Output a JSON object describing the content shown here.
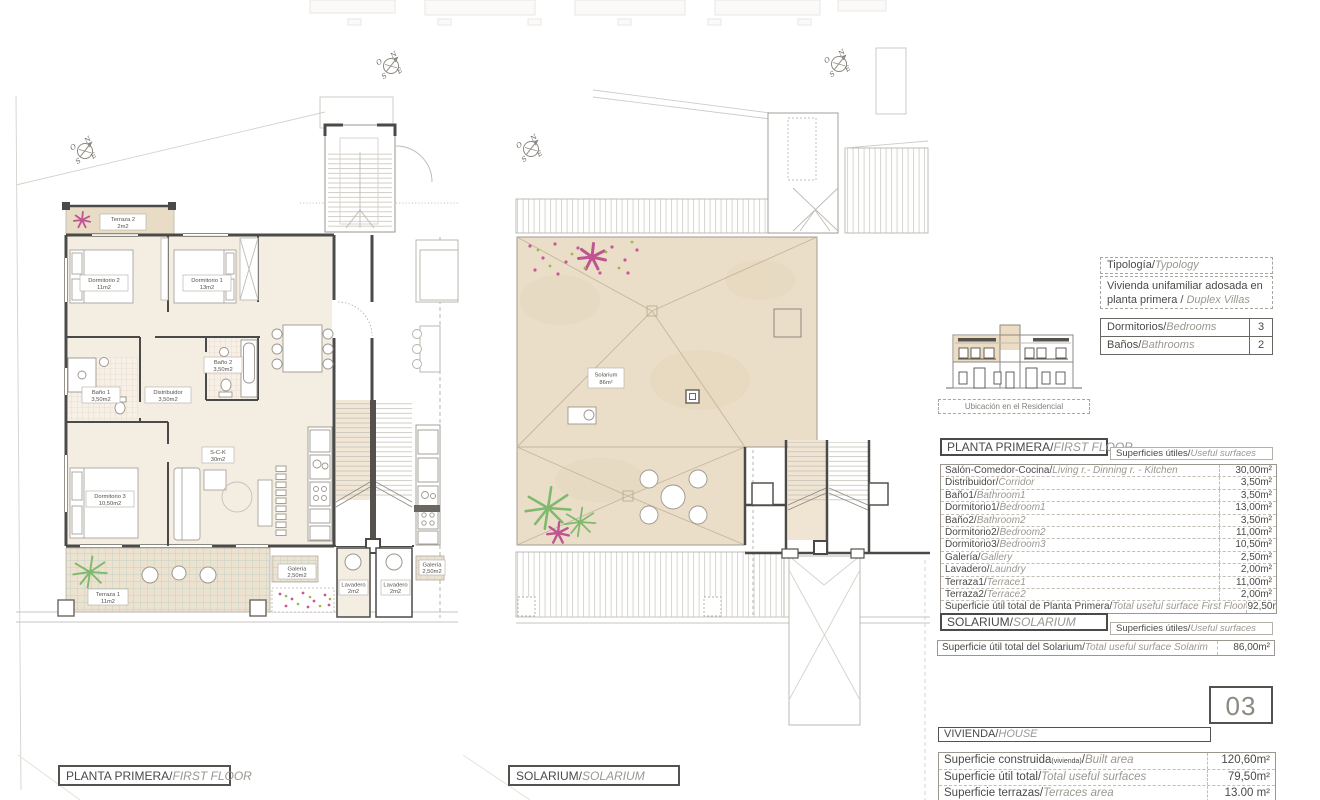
{
  "plans": {
    "compass": {
      "n": "N",
      "o": "O",
      "e": "E",
      "s": "S"
    },
    "first_floor": {
      "caption_es": "PLANTA PRIMERA/",
      "caption_en": "FIRST FLOOR",
      "rooms": [
        {
          "name": "Terraza 2",
          "area": "2m2"
        },
        {
          "name": "Dormitorio 2",
          "area": "11m2"
        },
        {
          "name": "Dormitorio 1",
          "area": "13m2"
        },
        {
          "name": "Baño 1",
          "area": "3,50m2"
        },
        {
          "name": "Baño 2",
          "area": "3,50m2"
        },
        {
          "name": "Distribuidor",
          "area": "3,50m2"
        },
        {
          "name": "Dormitorio 3",
          "area": "10,50m2"
        },
        {
          "name": "S-C-K",
          "area": "30m2"
        },
        {
          "name": "Terraza 1",
          "area": "11m2"
        },
        {
          "name": "Galería",
          "area": "2,50m2"
        },
        {
          "name": "Lavadero",
          "area": "2m2"
        },
        {
          "name": "Lavadero",
          "area": "2m2"
        },
        {
          "name": "Galería",
          "area": "2,50m2"
        }
      ]
    },
    "solarium": {
      "caption_es": "SOLARIUM/",
      "caption_en": "SOLARIUM",
      "label": {
        "name": "Solarium",
        "area": "86m²"
      }
    }
  },
  "panel": {
    "typology": {
      "title_es": "Tipología/",
      "title_en": "Typology",
      "body_es": "Vivienda unifamiliar adosada en planta primera / ",
      "body_en": "Duplex Villas"
    },
    "counts": [
      {
        "es": "Dormitorios/",
        "en": "Bedrooms",
        "value": "3"
      },
      {
        "es": "Baños/",
        "en": "Bathrooms",
        "value": "2"
      }
    ],
    "location_caption": "Ubicación en el Residencial",
    "first_floor_table": {
      "title_es": "PLANTA PRIMERA/",
      "title_en": "FIRST FLOOR",
      "subtitle_es": "Superficies útiles/",
      "subtitle_en": "Useful surfaces",
      "rows": [
        {
          "es": "Salón-Comedor-Cocina/",
          "en": "Living r.- Dinning r. - Kitchen",
          "value": "30,00m²"
        },
        {
          "es": "Distribuidor/",
          "en": "Corridor",
          "value": "3,50m²"
        },
        {
          "es": "Baño1/",
          "en": "Bathroom1",
          "value": "3,50m²"
        },
        {
          "es": "Dormitorio1/",
          "en": "Bedroom1",
          "value": "13,00m²"
        },
        {
          "es": "Baño2/",
          "en": "Bathroom2",
          "value": "3,50m²"
        },
        {
          "es": "Dormitorio2/",
          "en": "Bedroom2",
          "value": "11,00m²"
        },
        {
          "es": "Dormitorio3/",
          "en": "Bedroom3",
          "value": "10,50m²"
        },
        {
          "es": "Galería/",
          "en": "Gallery",
          "value": "2,50m²"
        },
        {
          "es": "Lavadero/",
          "en": "Laundry",
          "value": "2,00m²"
        },
        {
          "es": "Terraza1/",
          "en": "Terrace1",
          "value": "11,00m²"
        },
        {
          "es": "Terraza2/",
          "en": "Terrace2",
          "value": "2,00m²"
        },
        {
          "es": "Superficie útil total de Planta Primera/",
          "en": "Total useful surface First Floor",
          "value": "92,50m²"
        }
      ]
    },
    "solarium_table": {
      "title_es": "SOLARIUM/",
      "title_en": "SOLARIUM",
      "subtitle_es": "Superficies útiles/",
      "subtitle_en": "Useful surfaces",
      "rows": [
        {
          "es": "Superficie útil total del Solarium/",
          "en": "Total useful surface Solarim",
          "value": "86,00m²"
        }
      ]
    },
    "unit_number": "03",
    "house_table": {
      "title_es": "VIVIENDA/",
      "title_en": "HOUSE",
      "rows": [
        {
          "es": "Superficie construida",
          "sub": "(vivienda)",
          "sep": "/",
          "en": "Built area",
          "value": "120,60m²"
        },
        {
          "es": "Superficie útil total",
          "sub": "",
          "sep": "/",
          "en": "Total useful surfaces",
          "value": "79,50m²"
        },
        {
          "es": "Superficie terrazas",
          "sub": "",
          "sep": "/",
          "en": "Terraces area",
          "value": "13.00 m²"
        }
      ]
    }
  }
}
